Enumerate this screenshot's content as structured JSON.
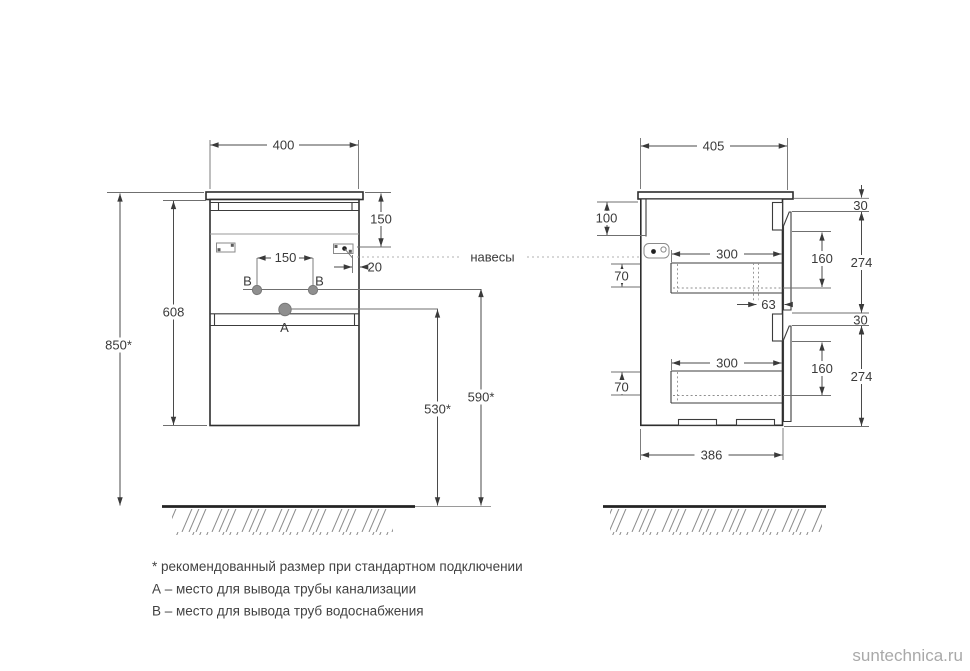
{
  "drawing": {
    "front": {
      "dim_width": "400",
      "dim_top_offset": "150",
      "dim_holes_spacing": "150",
      "dim_bracket_edge": "20",
      "dim_cabinet_height": "608",
      "dim_mount_height": "850*",
      "dim_drain_height": "530*",
      "dim_supply_height": "590*",
      "label_drain": "A",
      "label_supply": "B"
    },
    "side": {
      "dim_depth": "405",
      "dim_back_panel": "100",
      "dim_top_gap": "30",
      "dim_mid_gap": "30",
      "dim_drawer_inner_height": "160",
      "dim_drawer_front_height": "274",
      "dim_box_offset": "70",
      "dim_box_depth": "300",
      "dim_slide_offset": "63",
      "dim_bottom_depth": "386"
    },
    "callout_hangers": "навесы"
  },
  "notes": {
    "asterisk": "* рекомендованный размер при стандартном подключении",
    "a": "А – место для вывода трубы канализации",
    "b": "В – место для вывода труб водоснабжения"
  },
  "watermark": "suntechnica.ru",
  "colors": {
    "line": "#3a3a3a",
    "hatch": "#8c8c8c",
    "hole_fill": "#8f8f8f",
    "watermark": "#a9a9a9"
  }
}
